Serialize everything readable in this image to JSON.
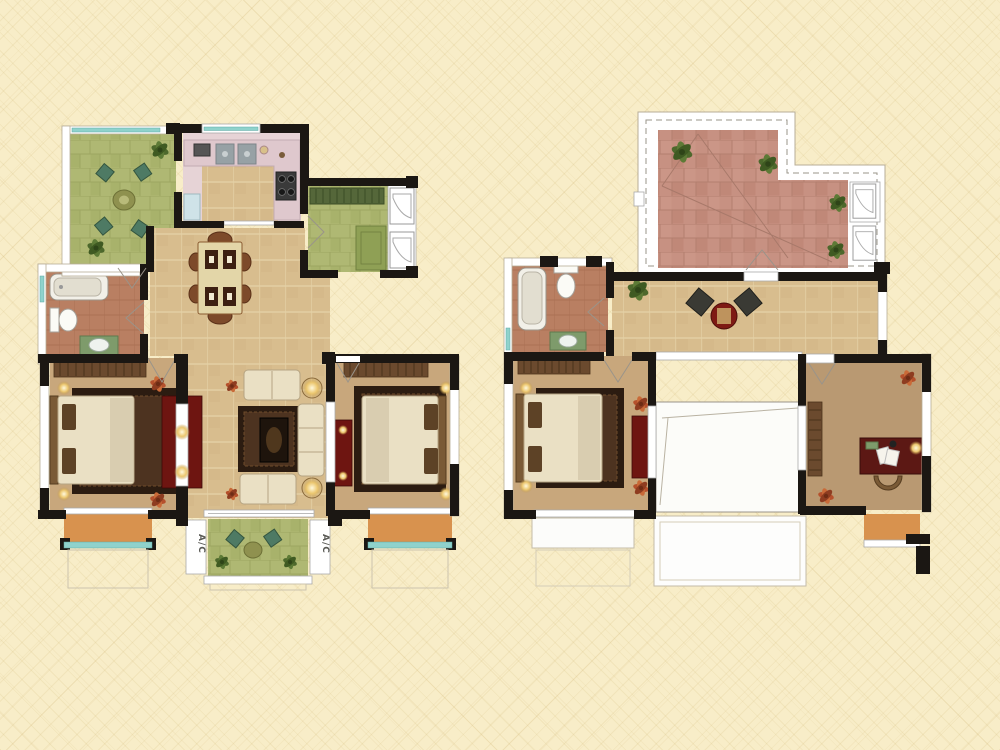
{
  "title": "duplex-floor-plans",
  "labels": {
    "ac": "A/C"
  },
  "plans": {
    "left": {
      "name": "lower-floor-plan"
    },
    "right": {
      "name": "upper-floor-plan"
    }
  },
  "colors": {
    "bg": "#f8edc8",
    "lattice": "#e7d5a3",
    "wall": "#1b1713",
    "band_stroke": "#b7ad97",
    "teal": "#8fd2cc",
    "tan": "#d8bd8e",
    "tan_line": "#e8d7ae",
    "green": "#afb873",
    "green_line": "#99a15c",
    "brick": "#c79182",
    "brick_line": "#b17d6d",
    "brown": "#b97f62",
    "brown_line": "#a96f52",
    "kitchen": "#e6d3d6",
    "counter": "#dfc8cd",
    "floor_bed": "#c8a77c",
    "floor_study": "#b99972",
    "orange": "#d8924e",
    "red_furn": "#6e1511",
    "wood": "#6b4a2e",
    "cream": "#eae0c4",
    "rug_outer": "#2c1c11",
    "rug_inner": "#4d3320",
    "sofa_stroke": "#b5a483",
    "plant_green": "#4d682c",
    "plant_orange": "#b5502c",
    "void": "#fcfcf9",
    "grey_line": "#9a948a"
  }
}
